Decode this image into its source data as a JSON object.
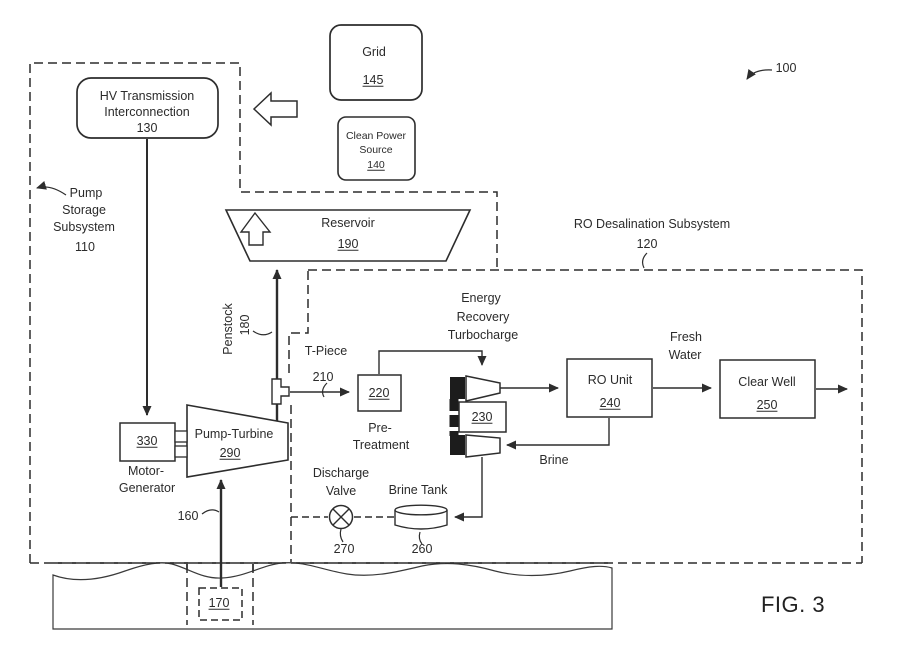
{
  "figure": {
    "fig_label": "FIG. 3",
    "overall_ref": "100"
  },
  "external_power": {
    "grid": {
      "label": "Grid",
      "ref": "145"
    },
    "clean_power_source": {
      "line1": "Clean Power",
      "line2": "Source",
      "ref": "140"
    }
  },
  "pump_storage_subsystem": {
    "label_line1": "Pump",
    "label_line2": "Storage",
    "label_line3": "Subsystem",
    "ref": "110",
    "hv_interconnection": {
      "line1": "HV Transmission",
      "line2": "Interconnection",
      "ref": "130"
    },
    "reservoir": {
      "label": "Reservoir",
      "ref": "190"
    },
    "penstock": {
      "label": "Penstock",
      "ref": "180"
    },
    "pump_turbine": {
      "label": "Pump-Turbine",
      "ref": "290"
    },
    "motor_generator": {
      "ref": "330",
      "line1": "Motor-",
      "line2": "Generator"
    },
    "intake_line_ref": "160",
    "intake_ref": "170"
  },
  "ro_desalination_subsystem": {
    "label": "RO Desalination Subsystem",
    "ref": "120",
    "t_piece": {
      "label": "T-Piece",
      "ref": "210"
    },
    "pre_treatment": {
      "ref": "220",
      "line1": "Pre-",
      "line2": "Treatment"
    },
    "energy_recovery": {
      "line1": "Energy",
      "line2": "Recovery",
      "line3": "Turbocharge",
      "ref": "230"
    },
    "ro_unit": {
      "label": "RO Unit",
      "ref": "240"
    },
    "fresh_water": {
      "line1": "Fresh",
      "line2": "Water"
    },
    "clear_well": {
      "label": "Clear Well",
      "ref": "250"
    },
    "brine_label": "Brine",
    "brine_tank": {
      "label": "Brine Tank",
      "ref": "260"
    },
    "discharge_valve": {
      "line1": "Discharge",
      "line2": "Valve",
      "ref": "270"
    }
  },
  "colors": {
    "line": "#2d2d2d",
    "text": "#2b2b2b",
    "solid_fill": "#1c1c1c",
    "background": "#ffffff"
  }
}
